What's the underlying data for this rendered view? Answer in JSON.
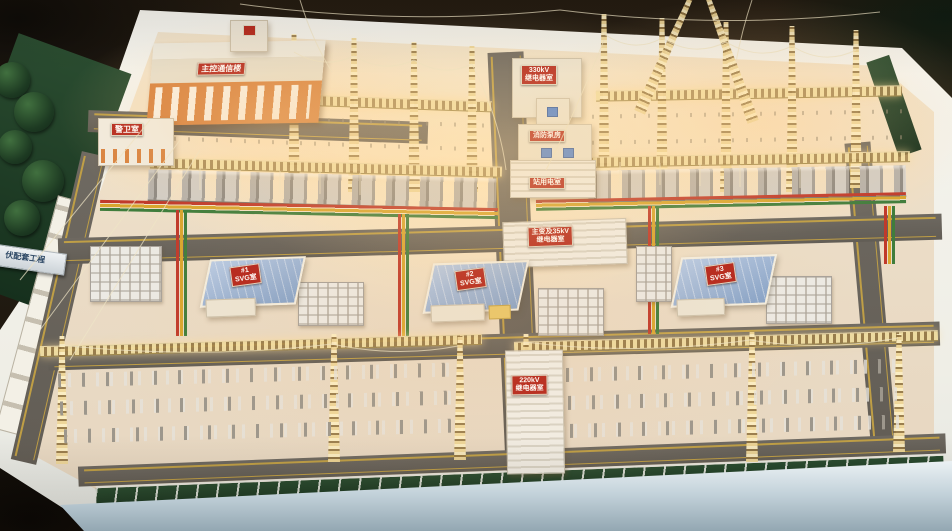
{
  "signs": {
    "project_plate": {
      "text": "伏配套工程"
    },
    "main_control": {
      "text": "主控通信楼"
    },
    "guard_room": {
      "text": "警卫室"
    },
    "relay_330kv": {
      "line1": "330kV",
      "line2": "继电器室"
    },
    "fire_pump": {
      "text": "消防泵房"
    },
    "station_power": {
      "text": "站用电室"
    },
    "mt_35kv_relay": {
      "line1": "主变及35kV",
      "line2": "继电器室"
    },
    "svg_room_1": {
      "line1": "#1",
      "line2": "SVG室"
    },
    "svg_room_2": {
      "line1": "#2",
      "line2": "SVG室"
    },
    "svg_room_3": {
      "line1": "#3",
      "line2": "SVG室"
    },
    "relay_220kv": {
      "line1": "220kV",
      "line2": "继电器室"
    }
  },
  "colors": {
    "sign_red": "#b4261c",
    "phase_red": "#c03a2b",
    "phase_yellow": "#d9a62e",
    "phase_green": "#3f7d3c",
    "truss_gold": "#e8d49a",
    "roof_blue": "#93aed2",
    "building_orange": "#d8823f",
    "lawn_green": "#1f3d24",
    "yard_cream": "#efe2cc",
    "road_gray": "#6b665e",
    "platform_white": "#f4f3ed"
  }
}
